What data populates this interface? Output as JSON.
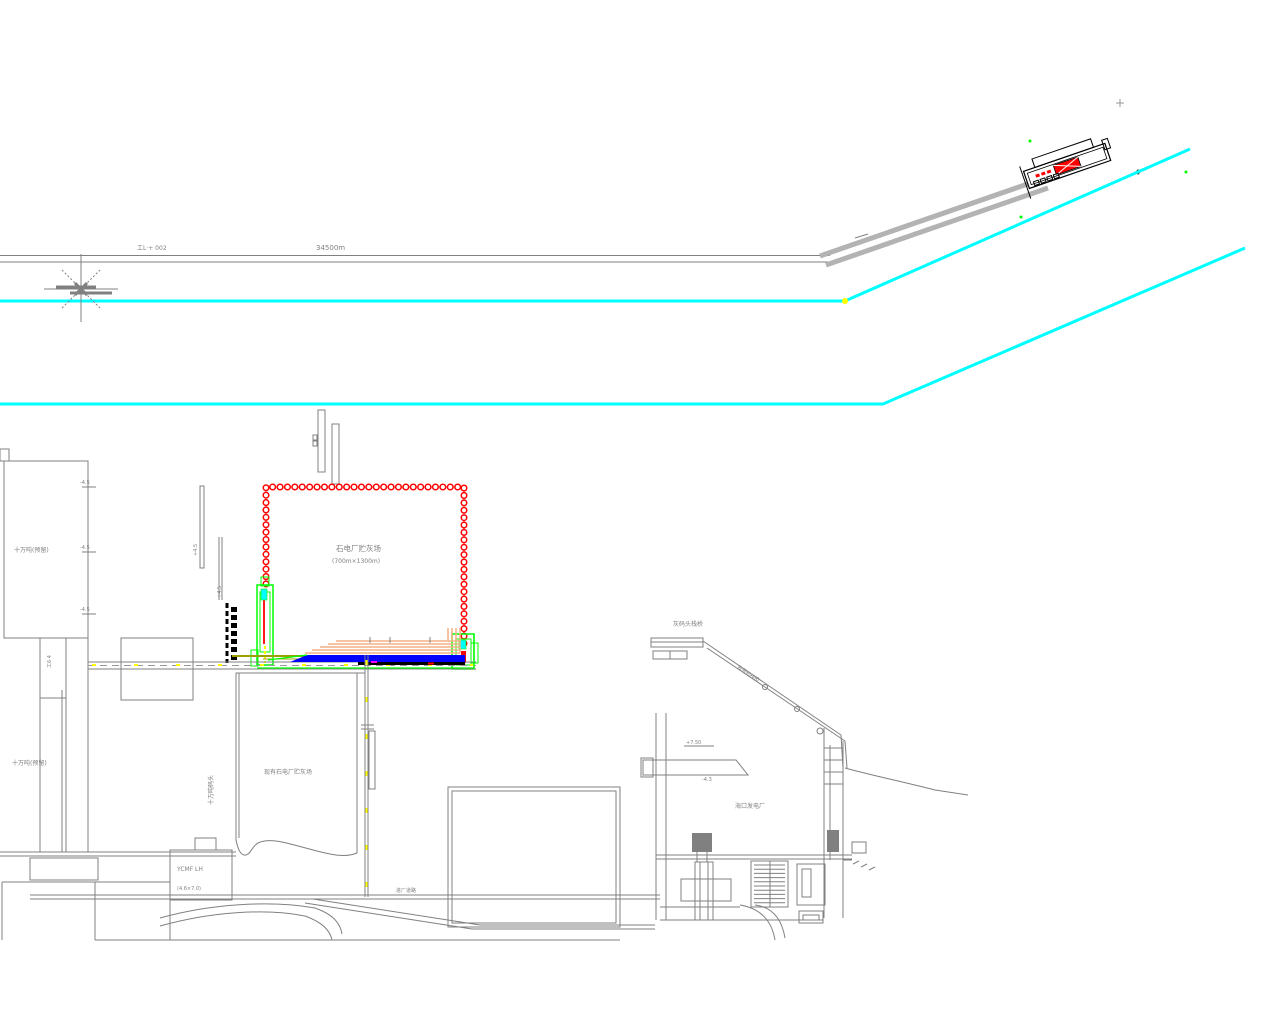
{
  "drawing": {
    "type": "coastal power plant ash-yard site plan (CAD)",
    "colors": {
      "shoreline_cyan": "#00FFFF",
      "pile_red": "#FF0000",
      "structure_green": "#00FF00",
      "pipeline_blue": "#0000FF",
      "marker_yellow": "#FFFF00",
      "marker_magenta": "#FF00FF",
      "dike_olive": "#9AA000",
      "pipe_peach": "#F4B183",
      "line_gray": "#808080",
      "trestle_gray": "#B3B3B3",
      "band_black": "#000000"
    },
    "labels": {
      "survey_note": "工L·+ 002",
      "distance": "34500m",
      "berth_upper": "十万吨(预留)",
      "berth_lower": "十万吨(预留)",
      "new_ash_yard_name": "石电厂贮灰场",
      "new_ash_yard_size": "(700m×1300m)",
      "existing_ash_yard": "现有石电厂贮灰场",
      "wharf_area": "灰码头栈桥",
      "plant_name": "海口发电厂",
      "building_code": "YCMF LH",
      "building_size": "(4.6×7.0)",
      "pier_vertical": "十万吨码头",
      "dock_vertical": "工6·4",
      "elev_a": "+7.50",
      "elev_b": "-4.3",
      "conveyor": "胶带机栈桥",
      "road": "进厂道路",
      "quay_mark_a": "+4.5",
      "quay_mark_b": "+4.5",
      "edge_ticks": [
        "-4.5",
        "-4.5",
        "-4.5"
      ]
    }
  }
}
